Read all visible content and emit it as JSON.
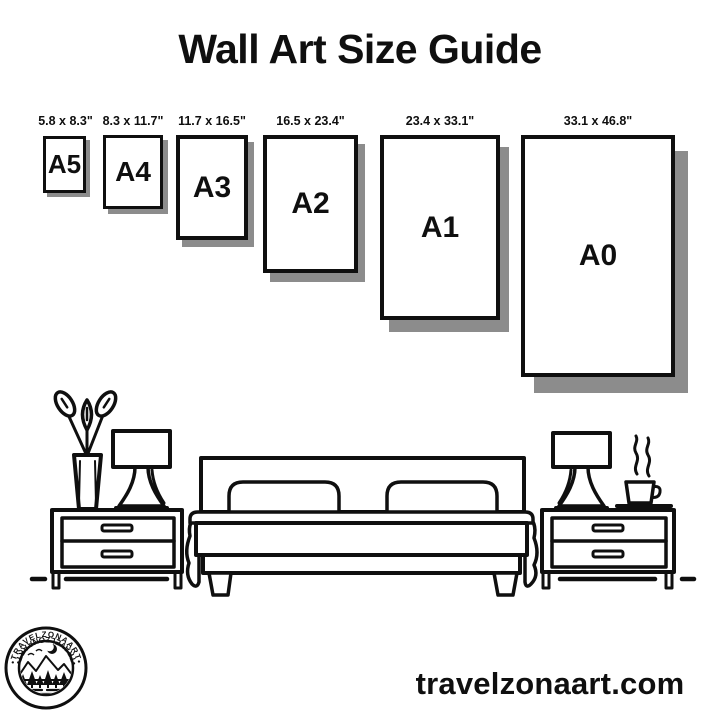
{
  "title": "Wall Art Size Guide",
  "sizes": [
    {
      "name": "A5",
      "dimensions": "5.8 x 8.3\""
    },
    {
      "name": "A4",
      "dimensions": "8.3 x 11.7\""
    },
    {
      "name": "A3",
      "dimensions": "11.7 x 16.5\""
    },
    {
      "name": "A2",
      "dimensions": "16.5 x 23.4\""
    },
    {
      "name": "A1",
      "dimensions": "23.4 x 33.1\""
    },
    {
      "name": "A0",
      "dimensions": "33.1 x 46.8\""
    }
  ],
  "logo": {
    "brand_top": "•TRAVELZONAART•",
    "brand_bottom": "•TRAVELZONAART•"
  },
  "footer": {
    "website": "travelzonaart.com"
  },
  "colors": {
    "ink": "#0f0f0f",
    "shadow": "#8c8c8c",
    "background": "#ffffff"
  },
  "illustration": {
    "icons": [
      "plant-vase-icon",
      "table-lamp-icon",
      "nightstand-icon",
      "double-bed-icon",
      "pillow-icon",
      "coffee-cup-icon",
      "floor-line"
    ]
  }
}
